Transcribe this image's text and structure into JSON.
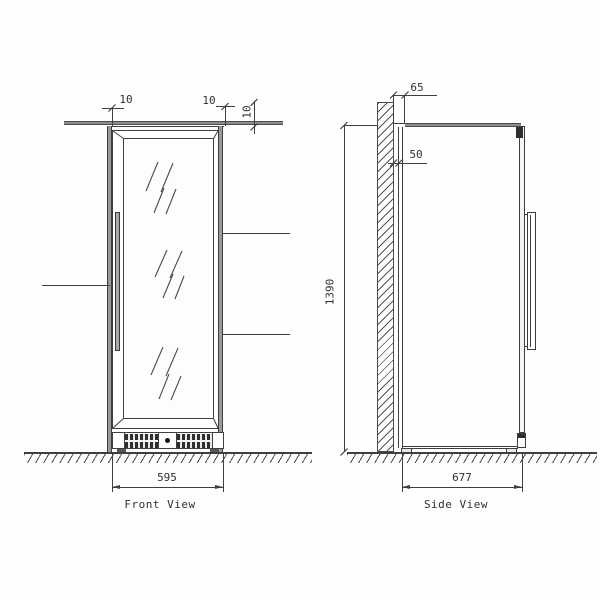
{
  "drawing": {
    "title": "Cabinet installation drawing",
    "front_view": {
      "label": "Front View",
      "dims": {
        "width": "595",
        "offset_left": "10",
        "offset_right": "10",
        "offset_top": "10"
      }
    },
    "side_view": {
      "label": "Side View",
      "dims": {
        "depth": "677",
        "height": "1390",
        "top_spacer": "65",
        "wall_clearance": "50"
      }
    }
  },
  "colors": {
    "line": "#3f3f3f",
    "thick_line": "#8c8c8c",
    "text": "#2f2f2f",
    "hinge": "#2e2e2e",
    "background": "#fefefe"
  }
}
